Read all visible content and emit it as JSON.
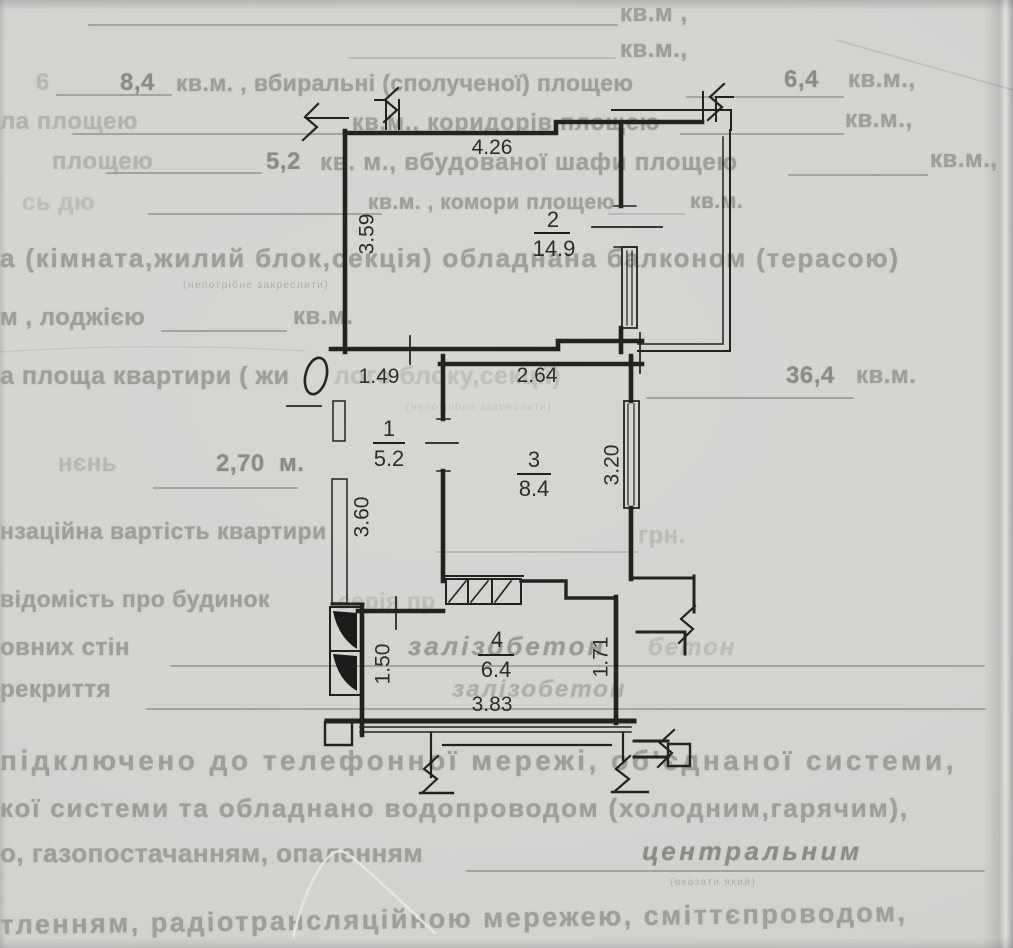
{
  "bg": {
    "l1": "кв.м ,",
    "l2": "кв.м.,",
    "l3_frag": "6",
    "l3_val1": "8,4",
    "l3_text": "кв.м. , вбиральні (сполученої) площею",
    "l3_val2": "6,4",
    "l3_end": "кв.м.,",
    "l4_frag": "ла площею",
    "l4_text": "кв.м., коридорів площею",
    "l4_end": "кв.м.,",
    "l5_frag": "площею",
    "l5_val": "5,2",
    "l5_text": "кв. м., вбудованої шафи площею",
    "l5_end": "кв.м.,",
    "l6_frag": "сь дю",
    "l6_text": "кв.м. , комори площею",
    "l6_end": "кв.м.",
    "l7_text": "а (кімната,жилий блок,секція) обладнана балконом (терасою)",
    "l7_sub": "(непотрібне закреслити)",
    "l8_frag": "м , лоджією",
    "l8_end": "кв.м.",
    "l9_text": "а площа квартири ( жи",
    "l9_text2": "лого блоку,секції)",
    "l9_val": "36,4",
    "l9_end": "кв.м.",
    "l9_sub": "(непотрібне закреслити)",
    "l10_frag": "нєнь",
    "l10_val": "2,70  м.",
    "l11_text": "нзаційна вартість квартири",
    "l11_end": "грн.",
    "l12_text": "відомість про будинок",
    "l12_text2": "серія пр",
    "l13_frag": "овних стін",
    "l13_val": "залізобетон",
    "l13_ghost": "бетон",
    "l14_frag": "рекриття",
    "l14_val": "залізобетон",
    "l15_text": "підключено до телефонної мережі, об'єднаної системи,",
    "l16_text": "кої системи та обладнано водопроводом (холодним,гарячим),",
    "l17_frag": "о, газопостачанням, опаленням",
    "l17_val": "центральним",
    "l17_sub": "(вказати який)",
    "l18_text": "тленням, радіотрансляційною мережею, сміттєпроводом,"
  },
  "plan": {
    "rooms": [
      {
        "num": "2",
        "area": "14.9"
      },
      {
        "num": "1",
        "area": "5.2"
      },
      {
        "num": "3",
        "area": "8.4"
      },
      {
        "num": "4",
        "area": "6.4"
      }
    ],
    "dims": {
      "top": "4.26",
      "room2_left": "3.59",
      "hall_top": "1.49",
      "room3_top": "2.64",
      "room3_right": "3.20",
      "hall_left": "3.60",
      "room4_left": "1.50",
      "room4_right": "1.71",
      "room4_bottom": "3.83"
    }
  },
  "colors": {
    "paper": "#d3d2cf",
    "ink": "#22211f",
    "faded_text": "#9f9e9a"
  }
}
